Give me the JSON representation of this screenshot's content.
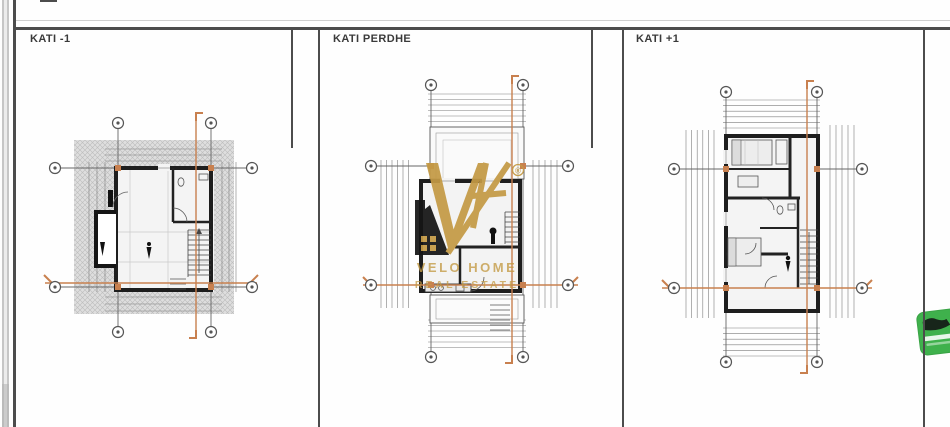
{
  "page": {
    "background": "#fefefe",
    "description": "architectural drawing sheet with three floor plans"
  },
  "panels": [
    {
      "id": "kati-minus-1",
      "title": "KATI -1"
    },
    {
      "id": "kati-perdhe",
      "title": "KATI PERDHE"
    },
    {
      "id": "kati-plus-1",
      "title": "KATI +1"
    }
  ],
  "watermark": {
    "letters": "VH",
    "registered": "®",
    "line1": "VELO HOME",
    "line2": "REAL ESTATE",
    "gold": "#c49a45",
    "black": "#151515"
  },
  "colors": {
    "frame_line": "#4c4c4c",
    "wall_dark": "#1e1e1e",
    "grid_line": "#666666",
    "dimension_line": "#7d7d7d",
    "hatch_bg": "#dedede",
    "accent_orange": "#c8804f",
    "badge_green": "#3fb14c"
  }
}
